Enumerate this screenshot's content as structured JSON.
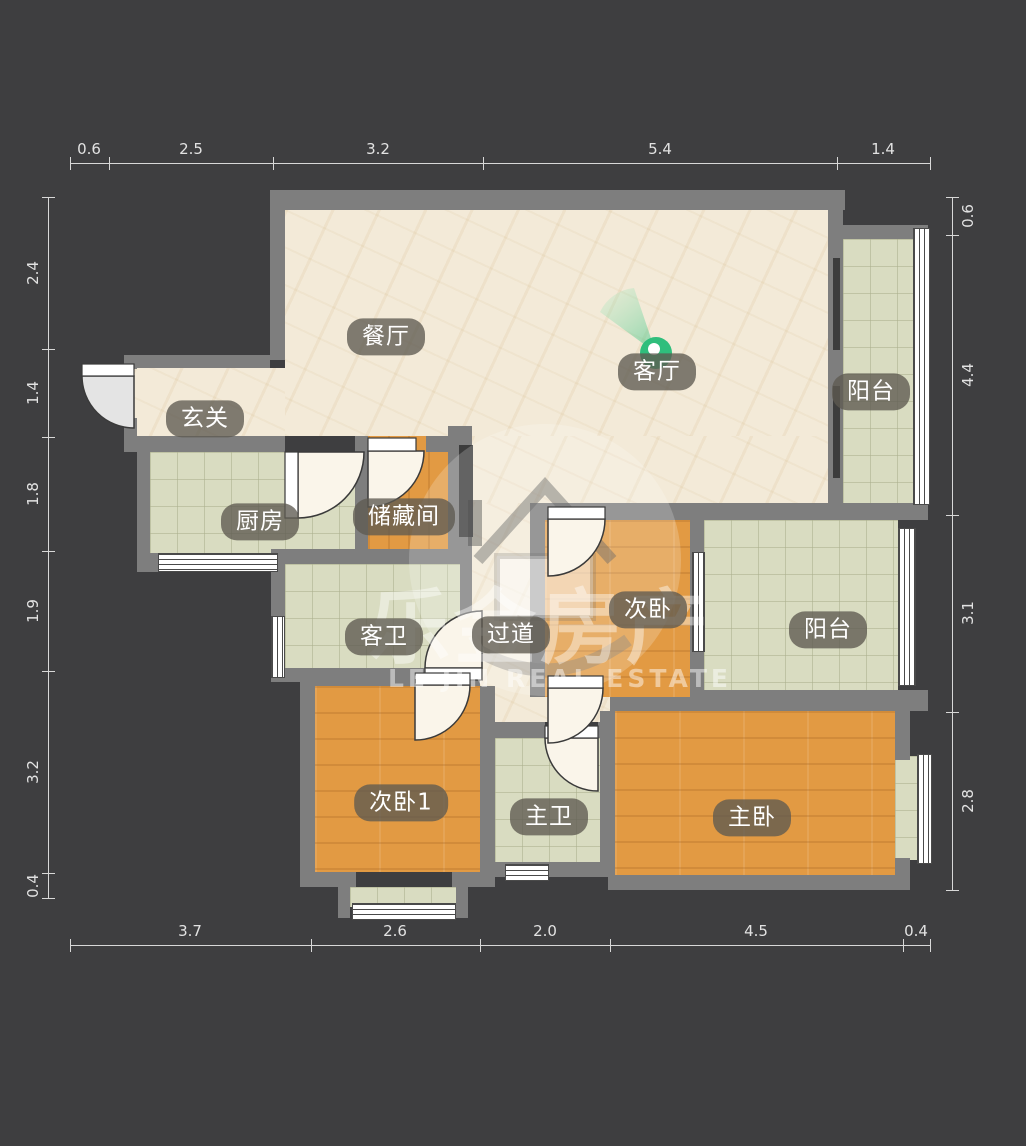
{
  "plan": {
    "type": "residential-floor-plan",
    "rooms": [
      {
        "name": "dining-room",
        "label": "餐厅"
      },
      {
        "name": "living-room",
        "label": "客厅"
      },
      {
        "name": "entryway",
        "label": "玄关"
      },
      {
        "name": "kitchen",
        "label": "厨房"
      },
      {
        "name": "storage-room",
        "label": "储藏间"
      },
      {
        "name": "guest-bathroom",
        "label": "客卫"
      },
      {
        "name": "hallway",
        "label": "过道"
      },
      {
        "name": "bedroom-2",
        "label": "次卧"
      },
      {
        "name": "balcony-top",
        "label": "阳台"
      },
      {
        "name": "balcony-right",
        "label": "阳台"
      },
      {
        "name": "bedroom-2-1",
        "label": "次卧1"
      },
      {
        "name": "master-bathroom",
        "label": "主卫"
      },
      {
        "name": "master-bedroom",
        "label": "主卧"
      }
    ],
    "camera_marker": {
      "room": "客厅",
      "kind": "panorama-viewpoint"
    },
    "dimensions_m": {
      "top": [
        "0.6",
        "2.5",
        "3.2",
        "5.4",
        "1.4"
      ],
      "bottom": [
        "3.7",
        "2.6",
        "2.0",
        "4.5",
        "0.4"
      ],
      "left": [
        "2.4",
        "1.4",
        "1.8",
        "1.9",
        "3.2",
        "0.4"
      ],
      "right": [
        "0.6",
        "4.4",
        "3.1",
        "2.8"
      ]
    },
    "watermark": {
      "text_cn": "乐金房产",
      "text_en": "LE JIN REAL ESTATE",
      "logo": "house-in-circle"
    },
    "colors": {
      "background": "#3E3E40",
      "wall": "#7E7E7E",
      "floor_beige": "#F3EAD8",
      "floor_wood": "#E29A43",
      "floor_tile": "#D9DCC1",
      "marker_green": "#2FBE7C"
    }
  }
}
